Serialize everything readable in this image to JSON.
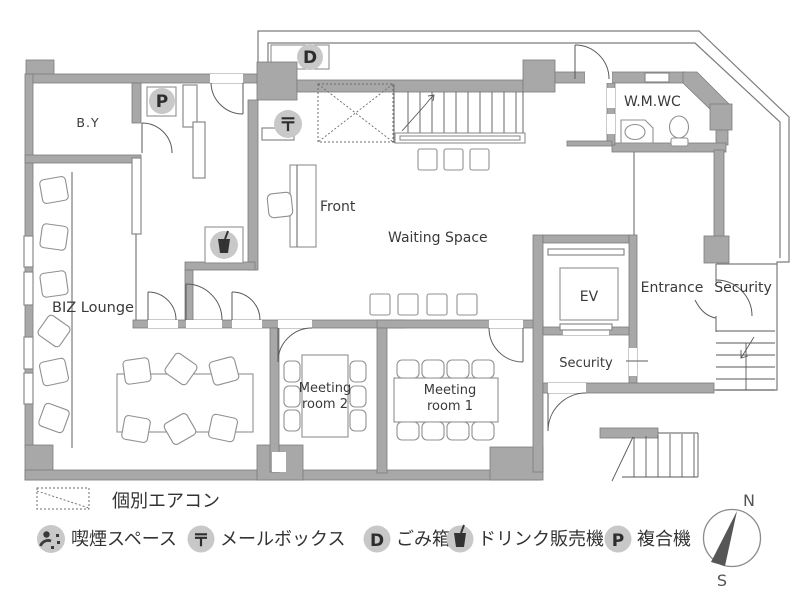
{
  "plan": {
    "rooms": {
      "by": "B.Y",
      "biz_lounge": "BIZ Lounge",
      "front": "Front",
      "waiting": "Waiting Space",
      "wc": "W.M.WC",
      "ev": "EV",
      "entrance": "Entrance",
      "security_right": "Security",
      "security_inner": "Security",
      "meeting2": [
        "Meeting",
        "room 2"
      ],
      "meeting1": [
        "Meeting",
        "room 1"
      ]
    },
    "compass": {
      "north": "N",
      "south": "S"
    }
  },
  "icons": {
    "printer": "P",
    "mailbox": "〒",
    "trash": "D"
  },
  "legend": {
    "aircon": "個別エアコン",
    "smoking": "喫煙スペース",
    "mailbox": "メールボックス",
    "trash": "ごみ箱",
    "vending": "ドリンク販売機",
    "copier": "複合機"
  },
  "colors": {
    "wall": "#a8a8a8",
    "icon_bg": "#c8c8c8",
    "line": "#7c7c7c",
    "text": "#3a3a3a",
    "needle": "#565656"
  }
}
